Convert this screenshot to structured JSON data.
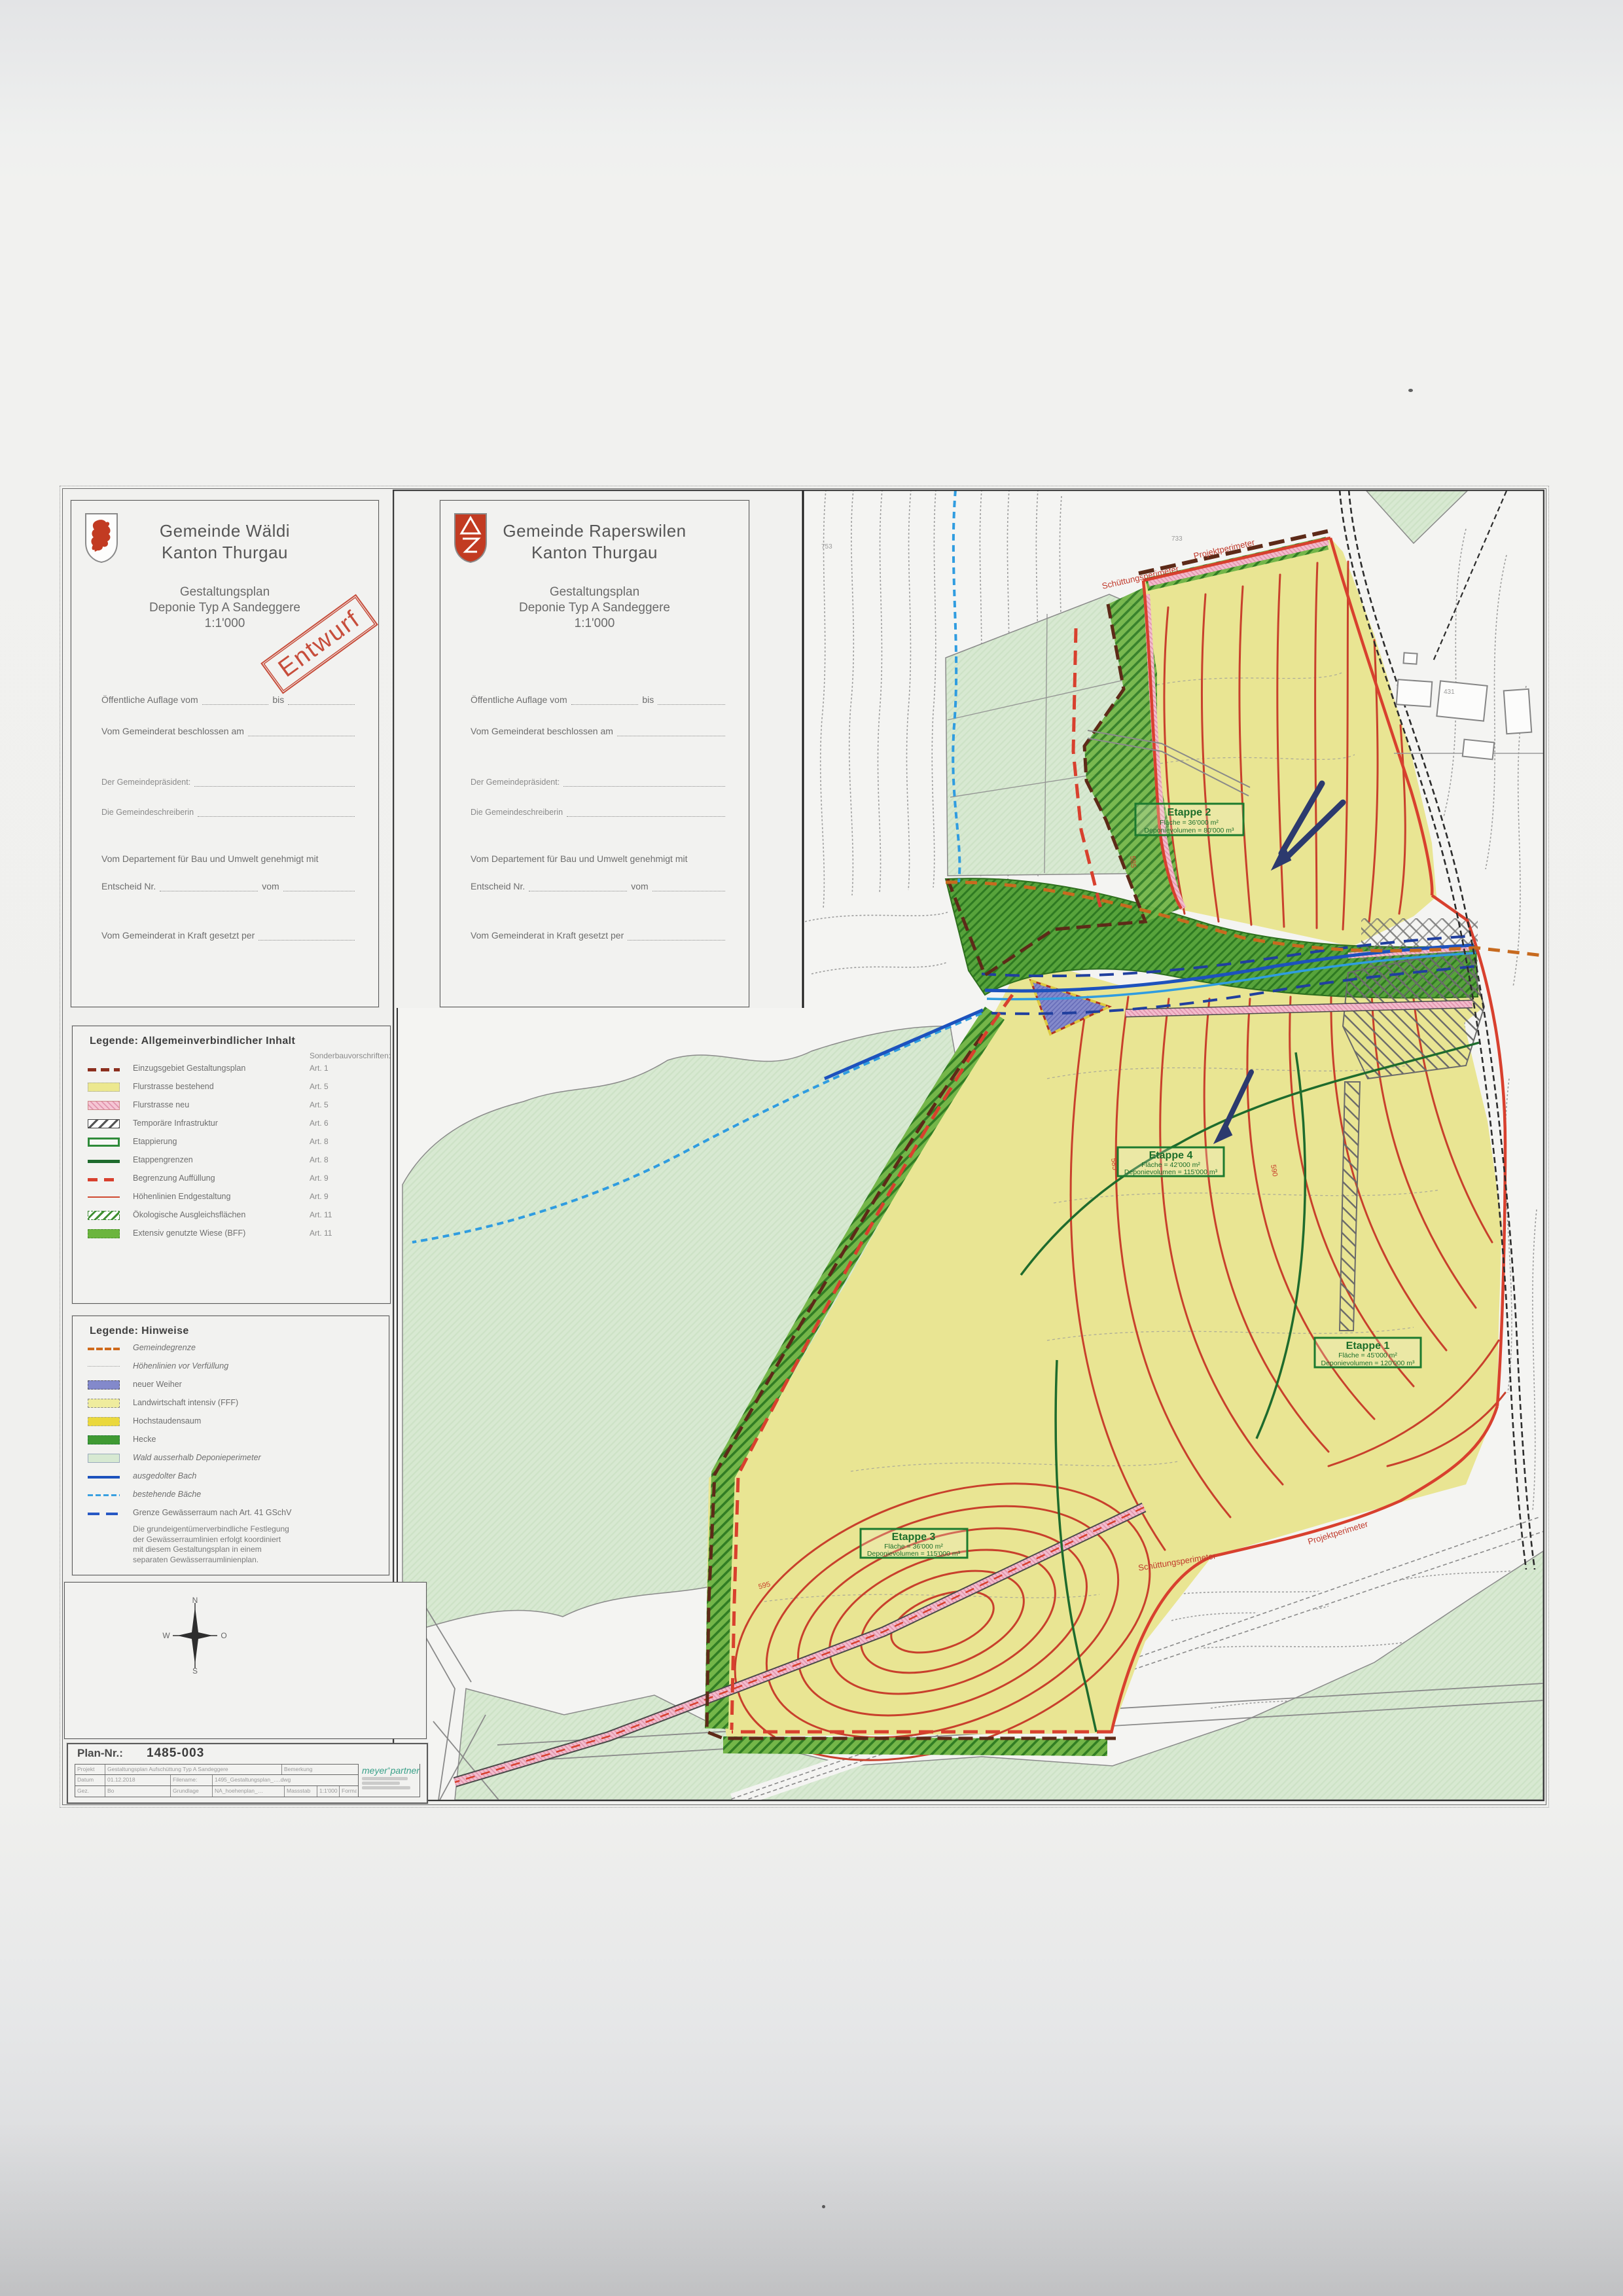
{
  "title_blocks": [
    {
      "gemeinde": "Gemeinde Wäldi",
      "kanton": "Kanton Thurgau",
      "plan_type": "Gestaltungsplan",
      "plan_name": "Deponie Typ A Sandeggere",
      "scale": "1:1'000"
    },
    {
      "gemeinde": "Gemeinde Raperswilen",
      "kanton": "Kanton Thurgau",
      "plan_type": "Gestaltungsplan",
      "plan_name": "Deponie Typ A Sandeggere",
      "scale": "1:1'000"
    }
  ],
  "stamp": "Entwurf",
  "approval": {
    "auflage": "Öffentliche Auflage vom",
    "bis": "bis",
    "beschlossen": "Vom Gemeinderat beschlossen am",
    "praesident": "Der Gemeindepräsident:",
    "schreiberin": "Die Gemeindeschreiberin",
    "departement": "Vom Departement für Bau und Umwelt genehmigt mit",
    "entscheid": "Entscheid Nr.",
    "vom": "vom",
    "inkraft": "Vom Gemeinderat in Kraft gesetzt per"
  },
  "legend_general": {
    "title": "Legende: Allgemeinverbindlicher Inhalt",
    "col_header": "Sonderbauvorschriften:",
    "items": [
      {
        "label": "Einzugsgebiet Gestaltungsplan",
        "art": "Art. 1",
        "swatch": "dark-red-dashed-line"
      },
      {
        "label": "Flurstrasse bestehend",
        "art": "Art. 5",
        "swatch": "yellow-fill"
      },
      {
        "label": "Flurstrasse neu",
        "art": "Art. 5",
        "swatch": "pink-hatch"
      },
      {
        "label": "Temporäre Infrastruktur",
        "art": "Art. 6",
        "swatch": "grey-hatch"
      },
      {
        "label": "Etappierung",
        "art": "Art. 8",
        "swatch": "green-outline"
      },
      {
        "label": "Etappengrenzen",
        "art": "Art. 8",
        "swatch": "dark-green-line"
      },
      {
        "label": "Begrenzung Auffüllung",
        "art": "Art. 9",
        "swatch": "red-dashed-line"
      },
      {
        "label": "Höhenlinien Endgestaltung",
        "art": "Art. 9",
        "swatch": "red-thin-line"
      },
      {
        "label": "Ökologische Ausgleichsflächen",
        "art": "Art. 11",
        "swatch": "green-hatch"
      },
      {
        "label": "Extensiv genutzte Wiese (BFF)",
        "art": "Art. 11",
        "swatch": "green-fill"
      }
    ]
  },
  "legend_hints": {
    "title": "Legende: Hinweise",
    "items": [
      {
        "label": "Gemeindegrenze",
        "swatch": "orange-line",
        "italic": true
      },
      {
        "label": "Höhenlinien vor Verfüllung",
        "swatch": "grey-dotted-line",
        "italic": true
      },
      {
        "label": "neuer Weiher",
        "swatch": "blue-violet-fill",
        "italic": false
      },
      {
        "label": "Landwirtschaft intensiv (FFF)",
        "swatch": "pale-yellow-fill",
        "italic": false
      },
      {
        "label": "Hochstaudensaum",
        "swatch": "yellow-fill",
        "italic": false
      },
      {
        "label": "Hecke",
        "swatch": "green-fill",
        "italic": false
      },
      {
        "label": "Wald ausserhalb Deponieperimeter",
        "swatch": "pale-green-fill",
        "italic": true
      },
      {
        "label": "ausgedolter Bach",
        "swatch": "blue-line",
        "italic": true
      },
      {
        "label": "bestehende Bäche",
        "swatch": "light-blue-dashed-line",
        "italic": true
      },
      {
        "label": "Grenze Gewässerraum nach Art. 41 GSchV",
        "swatch": "blue-long-dash-line",
        "italic": false
      }
    ],
    "note_lines": [
      "Die grundeigentümerverbindliche Festlegung",
      "der Gewässerraumlinien erfolgt koordiniert",
      "mit diesem Gestaltungsplan in einem",
      "separaten Gewässerraumlinienplan."
    ]
  },
  "compass": {
    "n": "N",
    "w": "W",
    "o": "O",
    "s": "S"
  },
  "plan_block": {
    "label": "Plan-Nr.:",
    "number": "1485-003",
    "table": {
      "row1": [
        "Projekt",
        "Gestaltungsplan Aufschüttung Typ A Sandeggere",
        "Bemerkung"
      ],
      "row2": [
        "Datum",
        "01.12.2018",
        "Filename:",
        "1495_Gestaltungsplan_….dwg"
      ],
      "row3": [
        "Gez.",
        "Bo",
        "Grundlage",
        "NA_hoehenplan_…",
        "Massstab",
        "1:1'000",
        "Format"
      ]
    },
    "logo": {
      "name_left": "meyer",
      "separator": "+",
      "name_right": "partner"
    }
  },
  "map": {
    "etappen": [
      {
        "name": "Etappe 1",
        "flaeche": "Fläche = 45'000 m²",
        "volumen": "Deponievolumen = 120'000 m³"
      },
      {
        "name": "Etappe 2",
        "flaeche": "Fläche = 36'000 m²",
        "volumen": "Deponievolumen = 80'000 m³"
      },
      {
        "name": "Etappe 3",
        "flaeche": "Fläche = 36'000 m²",
        "volumen": "Deponievolumen = 115'000 m³"
      },
      {
        "name": "Etappe 4",
        "flaeche": "Fläche = 42'000 m²",
        "volumen": "Deponievolumen = 115'000 m³"
      }
    ],
    "boundary_labels": {
      "top_schuettung": "Schüttungsperimeter",
      "top_projekt": "Projektperimeter",
      "bottom_schuettung": "Schüttungsperimeter",
      "bottom_projekt": "Projektperimeter"
    },
    "contour_labels": [
      "585",
      "585",
      "590",
      "595"
    ],
    "parcel_labels": [
      "753",
      "733",
      "431"
    ]
  },
  "colors": {
    "deposit_yellow": "#e9e593",
    "forest_green": "#d8e9d2",
    "band_green": "#57a33b",
    "hatch_green": "#74b649",
    "contour_red": "#c8402c",
    "boundary_red": "#d8402e",
    "einzugsgebiet_brown": "#5d2a18",
    "pond_blue": "#8389cb",
    "road_pink": "#f3bccd",
    "bach_blue": "#1d52bd",
    "baeche_lightblue": "#2f9ce0",
    "gemeindegrenze_orange": "#c76a1f",
    "stamp_red": "#c4402c"
  }
}
